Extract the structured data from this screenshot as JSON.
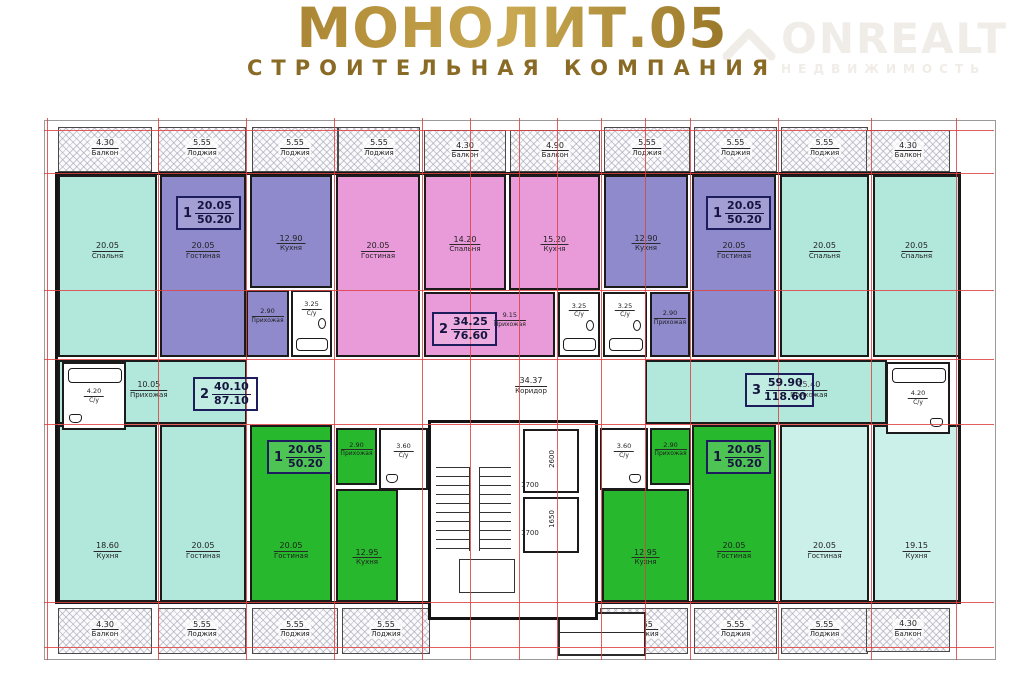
{
  "header": {
    "title": "МОНОЛИТ.05",
    "subtitle": "СТРОИТЕЛЬНАЯ КОМПАНИЯ"
  },
  "watermark": {
    "brand": "ONREALT",
    "tagline": "НЕДВИЖИМОСТЬ"
  },
  "plan": {
    "colors": {
      "teal": "#b2e8db",
      "teal_light": "#cbefe9",
      "purple": "#8f8acb",
      "pink": "#e99bd9",
      "green": "#27b82e",
      "gold": "#8f6c1d",
      "axis_red": "#de4242",
      "wall": "#1b1b1b",
      "watermark_gray": "#f0ece7"
    },
    "corridor": {
      "area": "34.37",
      "name": "Коридор"
    },
    "apartments": [
      {
        "num": "1",
        "upper": "20.05",
        "lower": "50.20"
      },
      {
        "num": "2",
        "upper": "34.25",
        "lower": "76.60"
      },
      {
        "num": "1",
        "upper": "20.05",
        "lower": "50.20"
      },
      {
        "num": "2",
        "upper": "40.10",
        "lower": "87.10"
      },
      {
        "num": "3",
        "upper": "59.90",
        "lower": "118.60"
      },
      {
        "num": "1",
        "upper": "20.05",
        "lower": "50.20"
      },
      {
        "num": "1",
        "upper": "20.05",
        "lower": "50.20"
      }
    ],
    "balconies_top": [
      {
        "area": "4.30",
        "name": "Балкон"
      },
      {
        "area": "5.55",
        "name": "Лоджия"
      },
      {
        "area": "5.55",
        "name": "Лоджия"
      },
      {
        "area": "5.55",
        "name": "Лоджия"
      },
      {
        "area": "4.30",
        "name": "Балкон"
      },
      {
        "area": "4.90",
        "name": "Балкон"
      },
      {
        "area": "5.55",
        "name": "Лоджия"
      },
      {
        "area": "5.55",
        "name": "Лоджия"
      },
      {
        "area": "5.55",
        "name": "Лоджия"
      },
      {
        "area": "4.30",
        "name": "Балкон"
      }
    ],
    "balconies_bottom": [
      {
        "area": "4.30",
        "name": "Балкон"
      },
      {
        "area": "5.55",
        "name": "Лоджия"
      },
      {
        "area": "5.55",
        "name": "Лоджия"
      },
      {
        "area": "5.55",
        "name": "Лоджия"
      },
      {
        "area": "5.55",
        "name": "Лоджия"
      },
      {
        "area": "5.55",
        "name": "Лоджия"
      },
      {
        "area": "5.55",
        "name": "Лоджия"
      },
      {
        "area": "4.30",
        "name": "Балкон"
      }
    ],
    "rooms": [
      {
        "area": "20.05",
        "name": "Спальня"
      },
      {
        "area": "20.05",
        "name": "Гостиная"
      },
      {
        "area": "12.90",
        "name": "Кухня"
      },
      {
        "area": "2.90",
        "name": "Прихожая"
      },
      {
        "area": "3.25",
        "name": "С/у"
      },
      {
        "area": "20.05",
        "name": "Гостиная"
      },
      {
        "area": "14.20",
        "name": "Спальня"
      },
      {
        "area": "15.20",
        "name": "Кухня"
      },
      {
        "area": "9.15",
        "name": "Прихожая"
      },
      {
        "area": "3.25",
        "name": "С/у"
      },
      {
        "area": "3.25",
        "name": "С/у"
      },
      {
        "area": "2.90",
        "name": "Прихожая"
      },
      {
        "area": "12.90",
        "name": "Кухня"
      },
      {
        "area": "20.05",
        "name": "Гостиная"
      },
      {
        "area": "20.05",
        "name": "Спальня"
      },
      {
        "area": "20.05",
        "name": "Спальня"
      },
      {
        "area": "4.20",
        "name": "С/у"
      },
      {
        "area": "10.05",
        "name": "Прихожая"
      },
      {
        "area": "15.40",
        "name": "Прихожая"
      },
      {
        "area": "4.20",
        "name": "С/у"
      },
      {
        "area": "18.60",
        "name": "Кухня"
      },
      {
        "area": "20.05",
        "name": "Гостиная"
      },
      {
        "area": "20.05",
        "name": "Гостиная"
      },
      {
        "area": "2.90",
        "name": "Прихожая"
      },
      {
        "area": "3.60",
        "name": "С/у"
      },
      {
        "area": "12.95",
        "name": "Кухня"
      },
      {
        "area": "3.60",
        "name": "С/у"
      },
      {
        "area": "2.90",
        "name": "Прихожая"
      },
      {
        "area": "12.95",
        "name": "Кухня"
      },
      {
        "area": "20.05",
        "name": "Гостиная"
      },
      {
        "area": "20.05",
        "name": "Гостиная"
      },
      {
        "area": "19.15",
        "name": "Кухня"
      }
    ],
    "stair_dims": [
      "2600",
      "1700",
      "1650",
      "1700"
    ]
  }
}
